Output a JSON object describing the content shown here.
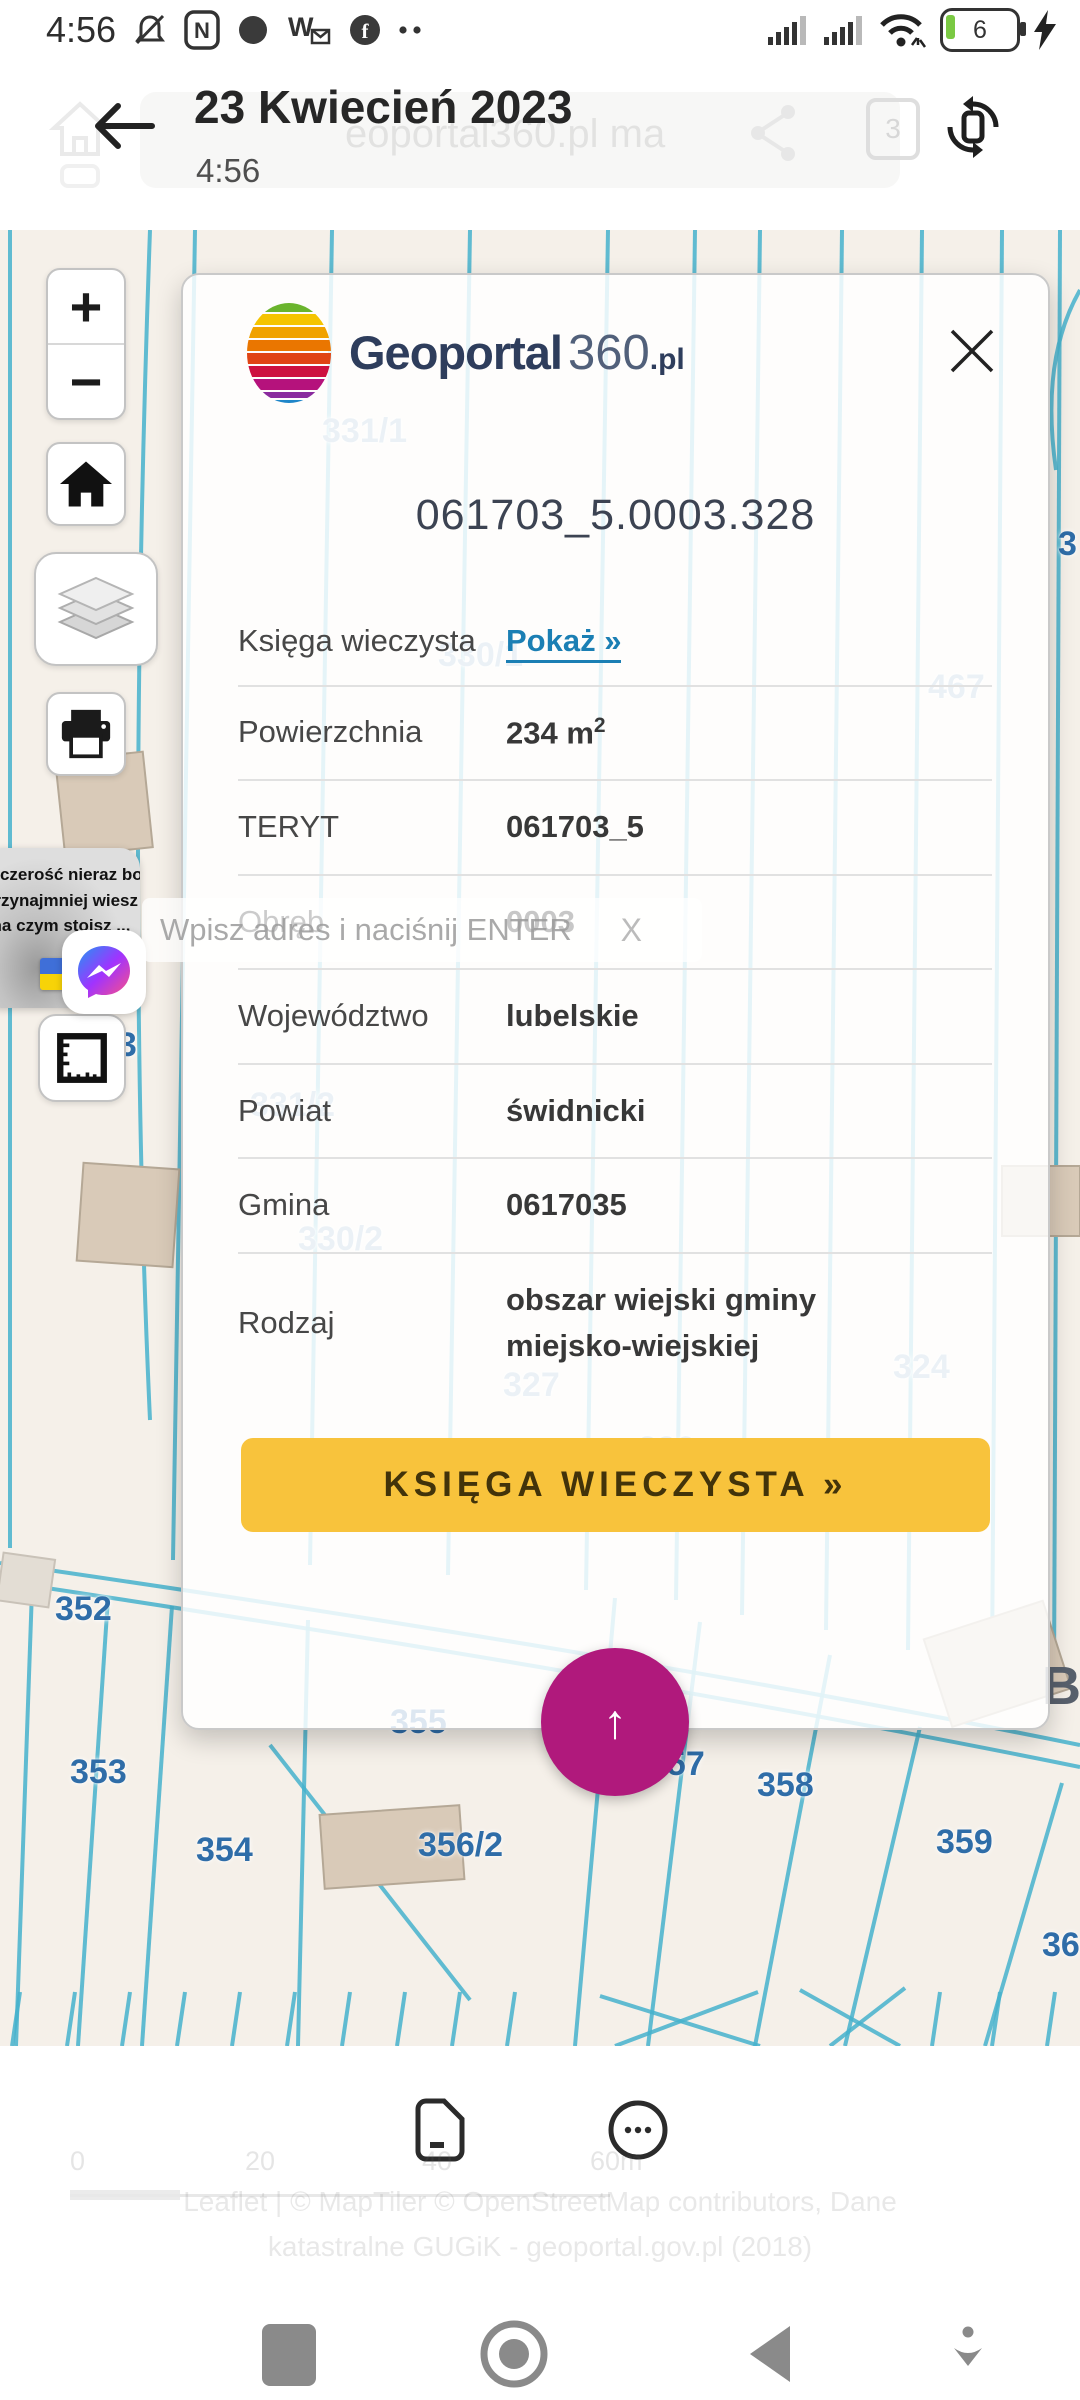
{
  "colors": {
    "map_line": "#45b1cc",
    "label_blue": "#2f6da8",
    "link": "#1b7fb4",
    "cta_bg": "#f8c33c",
    "fab": "#b0197c",
    "map_bg": "#f5f0e9"
  },
  "status_bar": {
    "time": "4:56",
    "battery_level": "6"
  },
  "header": {
    "title": "23 Kwiecień 2023",
    "subtitle": "4:56",
    "ghost_url": "eoportal360.pl ma",
    "badge": "3"
  },
  "sidebar": {
    "zoom_in": "+",
    "zoom_out": "−"
  },
  "search": {
    "placeholder": "Wpisz adres i naciśnij ENTER",
    "close": "X"
  },
  "meme": {
    "line1": "szczerość nieraz boli ...",
    "line2": "przynajmniej wiesz",
    "line3": "na czym stoisz ..."
  },
  "dialog": {
    "brand": {
      "bold": "Geoportal",
      "light": "360",
      "suffix": ".pl"
    },
    "parcel_id": "061703_5.0003.328",
    "rows": [
      {
        "label": "Księga wieczysta",
        "value": "Pokaż »"
      },
      {
        "label": "Powierzchnia",
        "value": "234 m",
        "sup": "2"
      },
      {
        "label": "TERYT",
        "value": "061703_5"
      },
      {
        "label": "Obręb",
        "value": "0003"
      },
      {
        "label": "Województwo",
        "value": "lubelskie"
      },
      {
        "label": "Powiat",
        "value": "świdnicki"
      },
      {
        "label": "Gmina",
        "value": "0617035"
      },
      {
        "label": "Rodzaj",
        "value": "obszar wiejski gminy miejsko-wiejskiej"
      }
    ],
    "cta": "KSIĘGA WIECZYSTA »"
  },
  "fab": {
    "arrow": "↑"
  },
  "map": {
    "labels": [
      {
        "text": "331/1",
        "x": 322,
        "y": 412,
        "ghost": true
      },
      {
        "text": "3",
        "x": 1058,
        "y": 525,
        "ghost": false
      },
      {
        "text": "330/1",
        "x": 438,
        "y": 636,
        "ghost": true
      },
      {
        "text": "467",
        "x": 928,
        "y": 668,
        "ghost": true
      },
      {
        "text": "333",
        "x": 80,
        "y": 1026,
        "ghost": false
      },
      {
        "text": "331/2",
        "x": 250,
        "y": 1086,
        "ghost": true
      },
      {
        "text": "330/2",
        "x": 298,
        "y": 1220,
        "ghost": true
      },
      {
        "text": "327",
        "x": 503,
        "y": 1366,
        "ghost": true
      },
      {
        "text": "324",
        "x": 893,
        "y": 1348,
        "ghost": true
      },
      {
        "text": "326",
        "x": 638,
        "y": 1430,
        "ghost": true
      },
      {
        "text": "352",
        "x": 55,
        "y": 1590,
        "ghost": false
      },
      {
        "text": "355",
        "x": 390,
        "y": 1703,
        "ghost": false
      },
      {
        "text": "353",
        "x": 70,
        "y": 1753,
        "ghost": false
      },
      {
        "text": "357",
        "x": 648,
        "y": 1745,
        "ghost": false
      },
      {
        "text": "358",
        "x": 757,
        "y": 1766,
        "ghost": false
      },
      {
        "text": "354",
        "x": 196,
        "y": 1831,
        "ghost": false
      },
      {
        "text": "356/2",
        "x": 418,
        "y": 1826,
        "ghost": false
      },
      {
        "text": "359",
        "x": 936,
        "y": 1823,
        "ghost": false
      },
      {
        "text": "360",
        "x": 1042,
        "y": 1926,
        "ghost": false
      },
      {
        "text": "B",
        "x": 1042,
        "y": 1655,
        "ghost": false,
        "big": true
      }
    ]
  },
  "footer": {
    "scale_ticks": [
      "0",
      "20",
      "40",
      "60m"
    ],
    "attr1": "Leaflet | © MapTiler © OpenStreetMap contributors, Dane",
    "attr2": "katastralne GUGiK - geoportal.gov.pl (2018)"
  }
}
